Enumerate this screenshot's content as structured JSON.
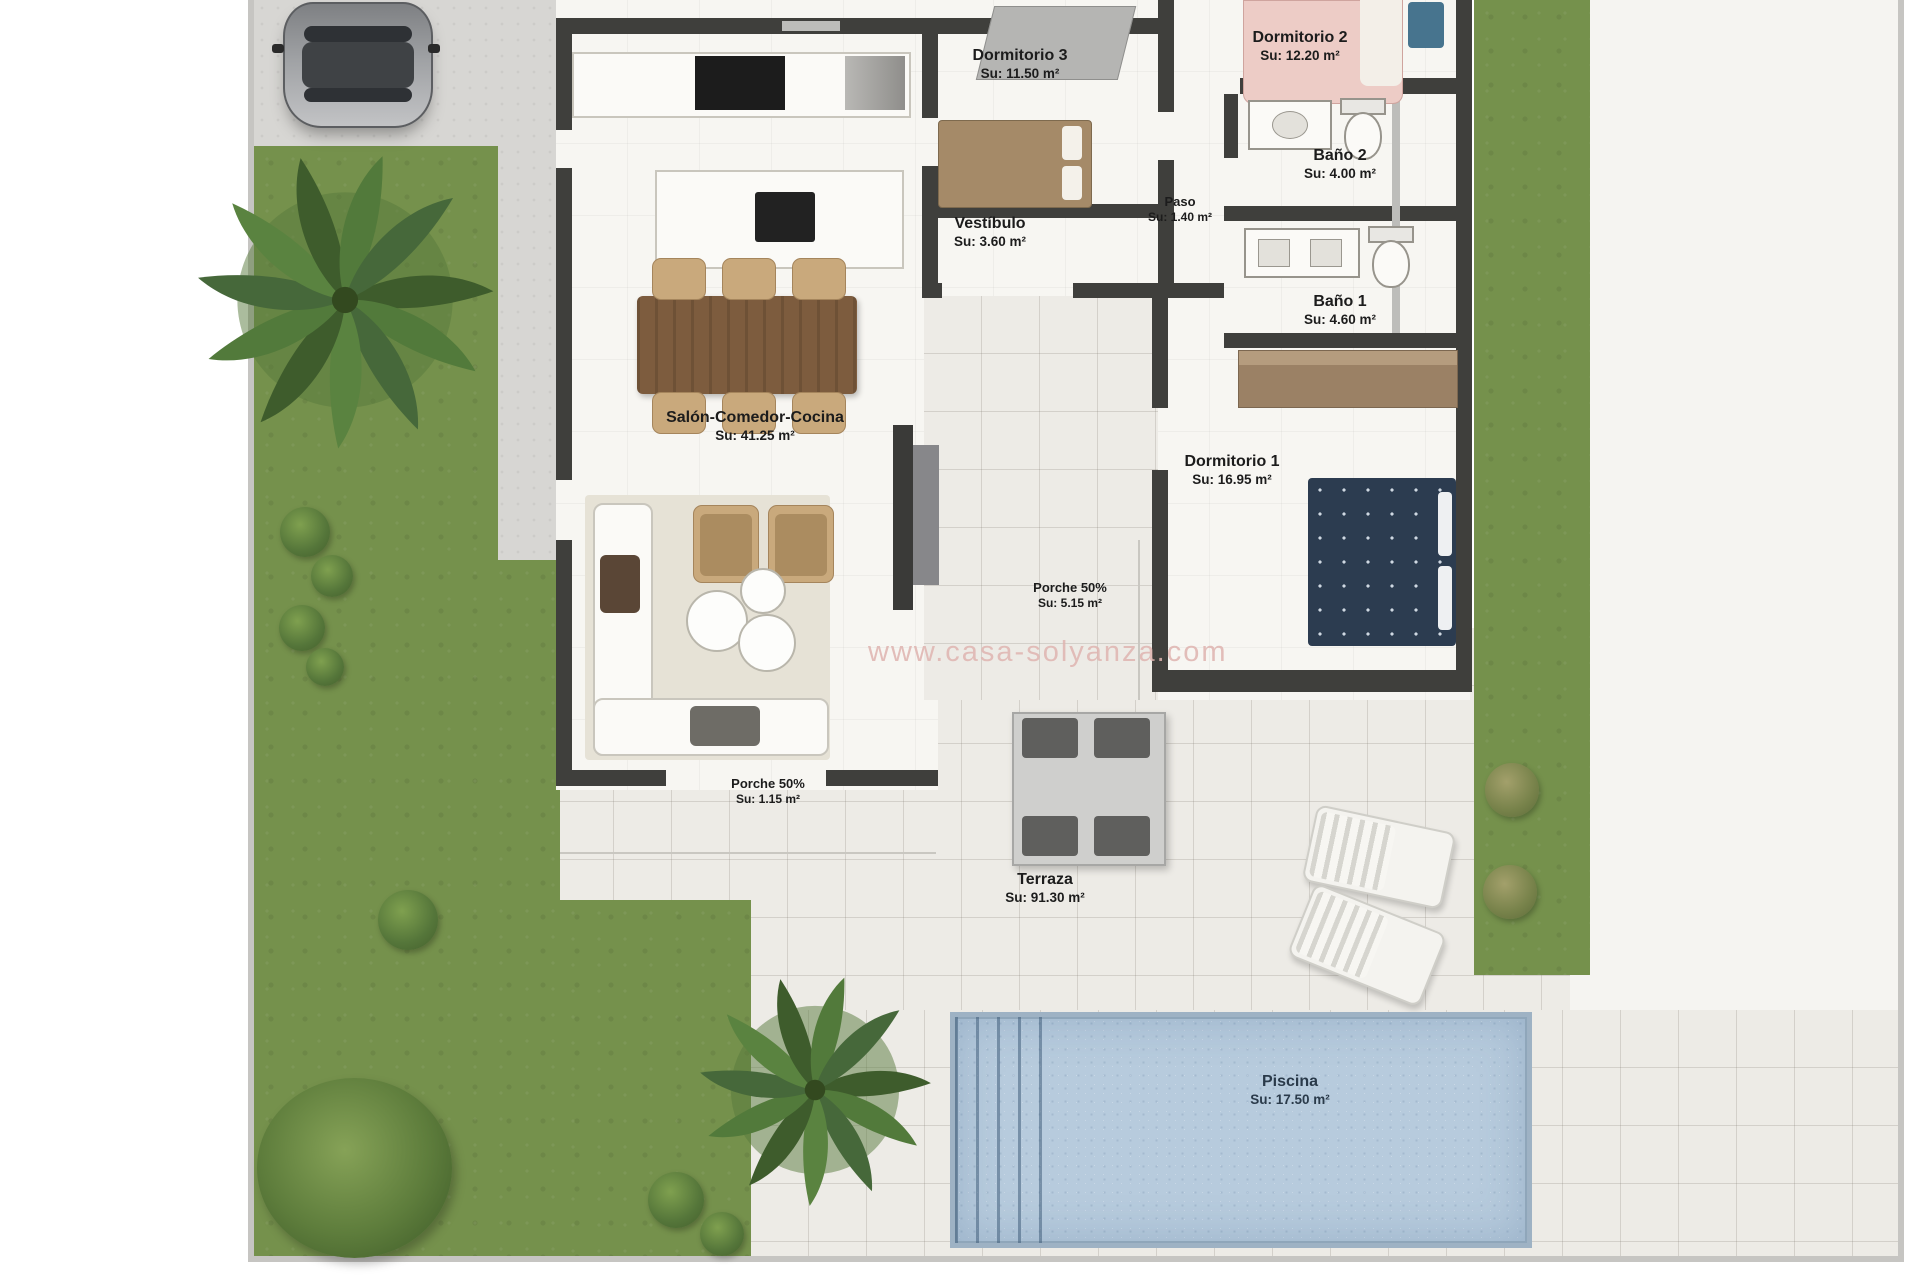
{
  "watermark": "www.casa-solyanza.com",
  "colors": {
    "grass": "#75914c",
    "concrete": "#d7d6d3",
    "tile": "#edebe6",
    "floor": "#f7f6f2",
    "wall": "#3f3f3c",
    "pool-water": "#b7cbdd",
    "pool-edge": "#9eb2c4",
    "wood": "#7d5c3e",
    "chair-tan": "#c9a97c",
    "bed-pink": "#edccc6",
    "bed-navy": "#2c3c50",
    "wardrobe": "#9b8165"
  },
  "rooms": {
    "dormitorio3": {
      "name": "Dormitorio 3",
      "area": "Su: 11.50 m²"
    },
    "dormitorio2": {
      "name": "Dormitorio 2",
      "area": "Su: 12.20 m²"
    },
    "bano2": {
      "name": "Baño 2",
      "area": "Su: 4.00 m²"
    },
    "paso": {
      "name": "Paso",
      "area": "Su: 1.40 m²"
    },
    "vestibulo": {
      "name": "Vestíbulo",
      "area": "Su: 3.60 m²"
    },
    "bano1": {
      "name": "Baño 1",
      "area": "Su: 4.60 m²"
    },
    "salon": {
      "name": "Salón-Comedor-Cocina",
      "area": "Su: 41.25 m²"
    },
    "dormitorio1": {
      "name": "Dormitorio 1",
      "area": "Su: 16.95 m²"
    },
    "porche_centro": {
      "name": "Porche 50%",
      "area": "Su: 5.15 m²"
    },
    "porche_oeste": {
      "name": "Porche 50%",
      "area": "Su: 1.15 m²"
    },
    "terraza": {
      "name": "Terraza",
      "area": "Su: 91.30 m²"
    },
    "piscina": {
      "name": "Piscina",
      "area": "Su: 17.50 m²"
    }
  }
}
